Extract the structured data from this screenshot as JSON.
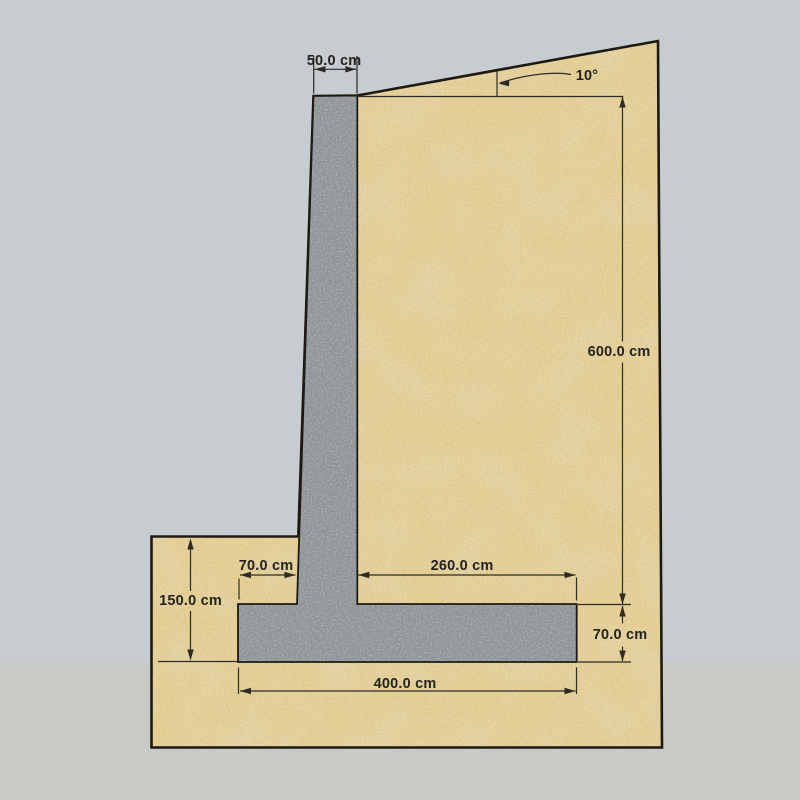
{
  "diagram": {
    "type": "retaining-wall-cross-section",
    "dimensions": {
      "wall_top_width": "50.0 cm",
      "backfill_slope_angle": "10°",
      "wall_height": "600.0 cm",
      "heel_length": "260.0 cm",
      "toe_length": "70.0 cm",
      "footing_thickness": "70.0 cm",
      "embedment_depth": "150.0 cm",
      "footing_width": "400.0 cm"
    }
  },
  "colors": {
    "soil": "#e7d197",
    "soil_blotch": "#c9ac66",
    "concrete": "#8e9397",
    "outline": "#1c1a12",
    "dimension": "#2d2b26",
    "background_upper": "#c7ccd1",
    "background_lower": "#c9c9c5"
  }
}
